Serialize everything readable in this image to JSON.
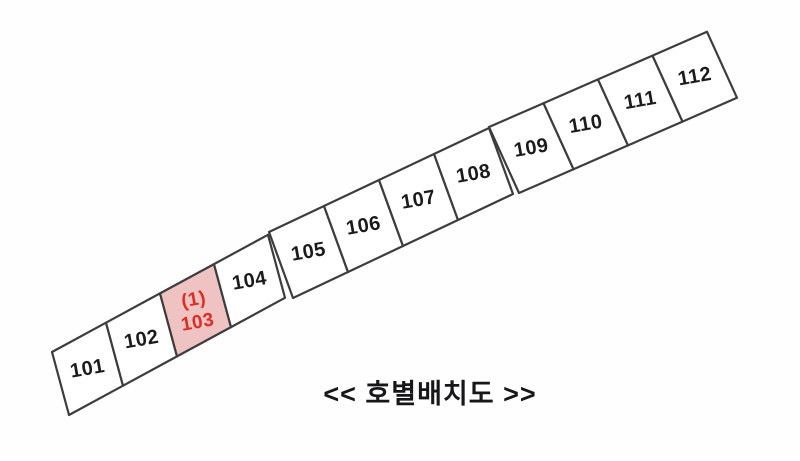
{
  "caption": "<< 호별배치도 >>",
  "units": [
    {
      "label": "101",
      "highlighted": false
    },
    {
      "label": "102",
      "highlighted": false
    },
    {
      "label": "103",
      "highlighted": true,
      "sub_label": "(1)"
    },
    {
      "label": "104",
      "highlighted": false
    },
    {
      "label": "105",
      "highlighted": false
    },
    {
      "label": "106",
      "highlighted": false
    },
    {
      "label": "107",
      "highlighted": false
    },
    {
      "label": "108",
      "highlighted": false
    },
    {
      "label": "109",
      "highlighted": false
    },
    {
      "label": "110",
      "highlighted": false
    },
    {
      "label": "111",
      "highlighted": false
    },
    {
      "label": "112",
      "highlighted": false
    }
  ],
  "colors": {
    "background": "#fefefe",
    "cell_fill": "#ffffff",
    "cell_stroke": "#3d3d3d",
    "label_color": "#1b1b1b",
    "highlight_fill": "#eec3c1",
    "highlight_text": "#e02b24",
    "caption_color": "#17171a"
  }
}
